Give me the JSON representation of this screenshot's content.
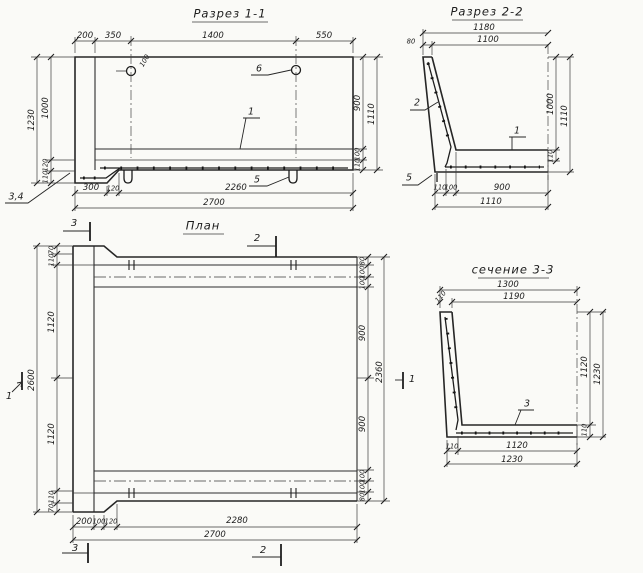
{
  "views": {
    "section_1_1": {
      "title": "Разрез 1-1",
      "labels": [
        {
          "role": "title",
          "text": "Разрез 1-1",
          "x": 230,
          "y": 14
        },
        {
          "role": "dim",
          "text": "200",
          "x": 85,
          "y": 36
        },
        {
          "role": "dim",
          "text": "350",
          "x": 113,
          "y": 36
        },
        {
          "role": "dim",
          "text": "1400",
          "x": 213,
          "y": 36
        },
        {
          "role": "dim",
          "text": "550",
          "x": 324,
          "y": 36
        },
        {
          "role": "dim",
          "size": "s",
          "text": "100",
          "x": 145,
          "y": 61,
          "rot": -60
        },
        {
          "role": "callout",
          "text": "6",
          "x": 259,
          "y": 69
        },
        {
          "role": "dim",
          "text": "1230",
          "x": 32,
          "y": 120,
          "rot": -90
        },
        {
          "role": "dim",
          "text": "1000",
          "x": 46,
          "y": 108,
          "rot": -90
        },
        {
          "role": "dim",
          "size": "s",
          "text": "120",
          "x": 46,
          "y": 165,
          "rot": -90
        },
        {
          "role": "dim",
          "size": "s",
          "text": "110",
          "x": 46,
          "y": 177,
          "rot": -90
        },
        {
          "role": "dim",
          "text": "900",
          "x": 358,
          "y": 103,
          "rot": -90
        },
        {
          "role": "dim",
          "text": "1110",
          "x": 372,
          "y": 114,
          "rot": -90
        },
        {
          "role": "dim",
          "size": "s",
          "text": "100",
          "x": 358,
          "y": 154,
          "rot": -90
        },
        {
          "role": "dim",
          "size": "s",
          "text": "110",
          "x": 358,
          "y": 165,
          "rot": -90
        },
        {
          "role": "callout",
          "text": "1",
          "x": 251,
          "y": 112
        },
        {
          "role": "callout",
          "text": "5",
          "x": 257,
          "y": 180
        },
        {
          "role": "callout",
          "text": "3,4",
          "x": 16,
          "y": 197
        },
        {
          "role": "dim",
          "text": "300",
          "x": 91,
          "y": 188
        },
        {
          "role": "dim",
          "size": "s",
          "text": "120",
          "x": 113,
          "y": 189
        },
        {
          "role": "dim",
          "text": "2260",
          "x": 236,
          "y": 188
        },
        {
          "role": "dim",
          "text": "2700",
          "x": 214,
          "y": 203
        }
      ]
    },
    "section_2_2": {
      "title": "Разрез 2-2",
      "labels": [
        {
          "role": "title",
          "text": "Разрез 2-2",
          "x": 487,
          "y": 12
        },
        {
          "role": "dim",
          "text": "1180",
          "x": 484,
          "y": 28
        },
        {
          "role": "dim",
          "text": "1100",
          "x": 488,
          "y": 40
        },
        {
          "role": "dim",
          "size": "s",
          "text": "80",
          "x": 411,
          "y": 42
        },
        {
          "role": "callout",
          "text": "2",
          "x": 417,
          "y": 103
        },
        {
          "role": "dim",
          "text": "1000",
          "x": 551,
          "y": 104,
          "rot": -90
        },
        {
          "role": "dim",
          "text": "1110",
          "x": 565,
          "y": 116,
          "rot": -90
        },
        {
          "role": "dim",
          "size": "s",
          "text": "110",
          "x": 551,
          "y": 156,
          "rot": -90
        },
        {
          "role": "callout",
          "text": "1",
          "x": 517,
          "y": 131
        },
        {
          "role": "callout",
          "text": "5",
          "x": 409,
          "y": 178
        },
        {
          "role": "dim",
          "size": "s",
          "text": "110",
          "x": 440,
          "y": 188
        },
        {
          "role": "dim",
          "size": "s",
          "text": "100",
          "x": 451,
          "y": 188
        },
        {
          "role": "dim",
          "text": "900",
          "x": 502,
          "y": 188
        },
        {
          "role": "dim",
          "text": "1110",
          "x": 491,
          "y": 202
        }
      ]
    },
    "plan": {
      "title": "План",
      "labels": [
        {
          "role": "title",
          "text": "План",
          "x": 203,
          "y": 226
        },
        {
          "role": "marker",
          "text": "3",
          "x": 74,
          "y": 224
        },
        {
          "role": "marker",
          "text": "2",
          "x": 257,
          "y": 239
        },
        {
          "role": "dim",
          "size": "s",
          "text": "70",
          "x": 52,
          "y": 250,
          "rot": -90
        },
        {
          "role": "dim",
          "size": "s",
          "text": "110",
          "x": 52,
          "y": 260,
          "rot": -90
        },
        {
          "role": "dim",
          "text": "1120",
          "x": 52,
          "y": 322,
          "rot": -90
        },
        {
          "role": "dim",
          "text": "2600",
          "x": 32,
          "y": 380,
          "rot": -90
        },
        {
          "role": "dim",
          "text": "1120",
          "x": 52,
          "y": 434,
          "rot": -90
        },
        {
          "role": "dim",
          "size": "s",
          "text": "110",
          "x": 52,
          "y": 497,
          "rot": -90
        },
        {
          "role": "dim",
          "size": "s",
          "text": "70",
          "x": 52,
          "y": 508,
          "rot": -90
        },
        {
          "role": "marker",
          "text": "1",
          "x": 9,
          "y": 397
        },
        {
          "role": "dim",
          "size": "s",
          "text": "80",
          "x": 363,
          "y": 261,
          "rot": -90
        },
        {
          "role": "dim",
          "size": "s",
          "text": "100",
          "x": 363,
          "y": 272,
          "rot": -90
        },
        {
          "role": "dim",
          "size": "s",
          "text": "100",
          "x": 363,
          "y": 283,
          "rot": -90
        },
        {
          "role": "dim",
          "text": "900",
          "x": 363,
          "y": 333,
          "rot": -90
        },
        {
          "role": "dim",
          "text": "2360",
          "x": 380,
          "y": 372,
          "rot": -90
        },
        {
          "role": "dim",
          "text": "900",
          "x": 363,
          "y": 424,
          "rot": -90
        },
        {
          "role": "dim",
          "size": "s",
          "text": "100",
          "x": 363,
          "y": 476,
          "rot": -90
        },
        {
          "role": "dim",
          "size": "s",
          "text": "100",
          "x": 363,
          "y": 487,
          "rot": -90
        },
        {
          "role": "dim",
          "size": "s",
          "text": "80",
          "x": 363,
          "y": 497,
          "rot": -90
        },
        {
          "role": "marker",
          "text": "1",
          "x": 412,
          "y": 380
        },
        {
          "role": "dim",
          "text": "200",
          "x": 84,
          "y": 522
        },
        {
          "role": "dim",
          "size": "s",
          "text": "100",
          "x": 99,
          "y": 522
        },
        {
          "role": "dim",
          "size": "s",
          "text": "120",
          "x": 111,
          "y": 522
        },
        {
          "role": "dim",
          "text": "2280",
          "x": 237,
          "y": 521
        },
        {
          "role": "dim",
          "text": "2700",
          "x": 215,
          "y": 535
        },
        {
          "role": "marker",
          "text": "3",
          "x": 75,
          "y": 549
        },
        {
          "role": "marker",
          "text": "2",
          "x": 263,
          "y": 551
        }
      ]
    },
    "section_3_3": {
      "title": "сечение 3-3",
      "labels": [
        {
          "role": "title",
          "text": "сечение 3-3",
          "x": 513,
          "y": 270
        },
        {
          "role": "dim",
          "text": "1300",
          "x": 508,
          "y": 285
        },
        {
          "role": "dim",
          "text": "1190",
          "x": 514,
          "y": 297
        },
        {
          "role": "dim",
          "size": "s",
          "text": "110",
          "x": 441,
          "y": 297,
          "rot": -50
        },
        {
          "role": "dim",
          "text": "1120",
          "x": 585,
          "y": 367,
          "rot": -90
        },
        {
          "role": "dim",
          "text": "1230",
          "x": 598,
          "y": 374,
          "rot": -90
        },
        {
          "role": "dim",
          "size": "s",
          "text": "110",
          "x": 585,
          "y": 430,
          "rot": -90
        },
        {
          "role": "callout",
          "text": "3",
          "x": 527,
          "y": 404
        },
        {
          "role": "dim",
          "size": "s",
          "text": "110",
          "x": 452,
          "y": 447
        },
        {
          "role": "dim",
          "text": "1120",
          "x": 517,
          "y": 446
        },
        {
          "role": "dim",
          "text": "1230",
          "x": 512,
          "y": 460
        }
      ]
    }
  }
}
